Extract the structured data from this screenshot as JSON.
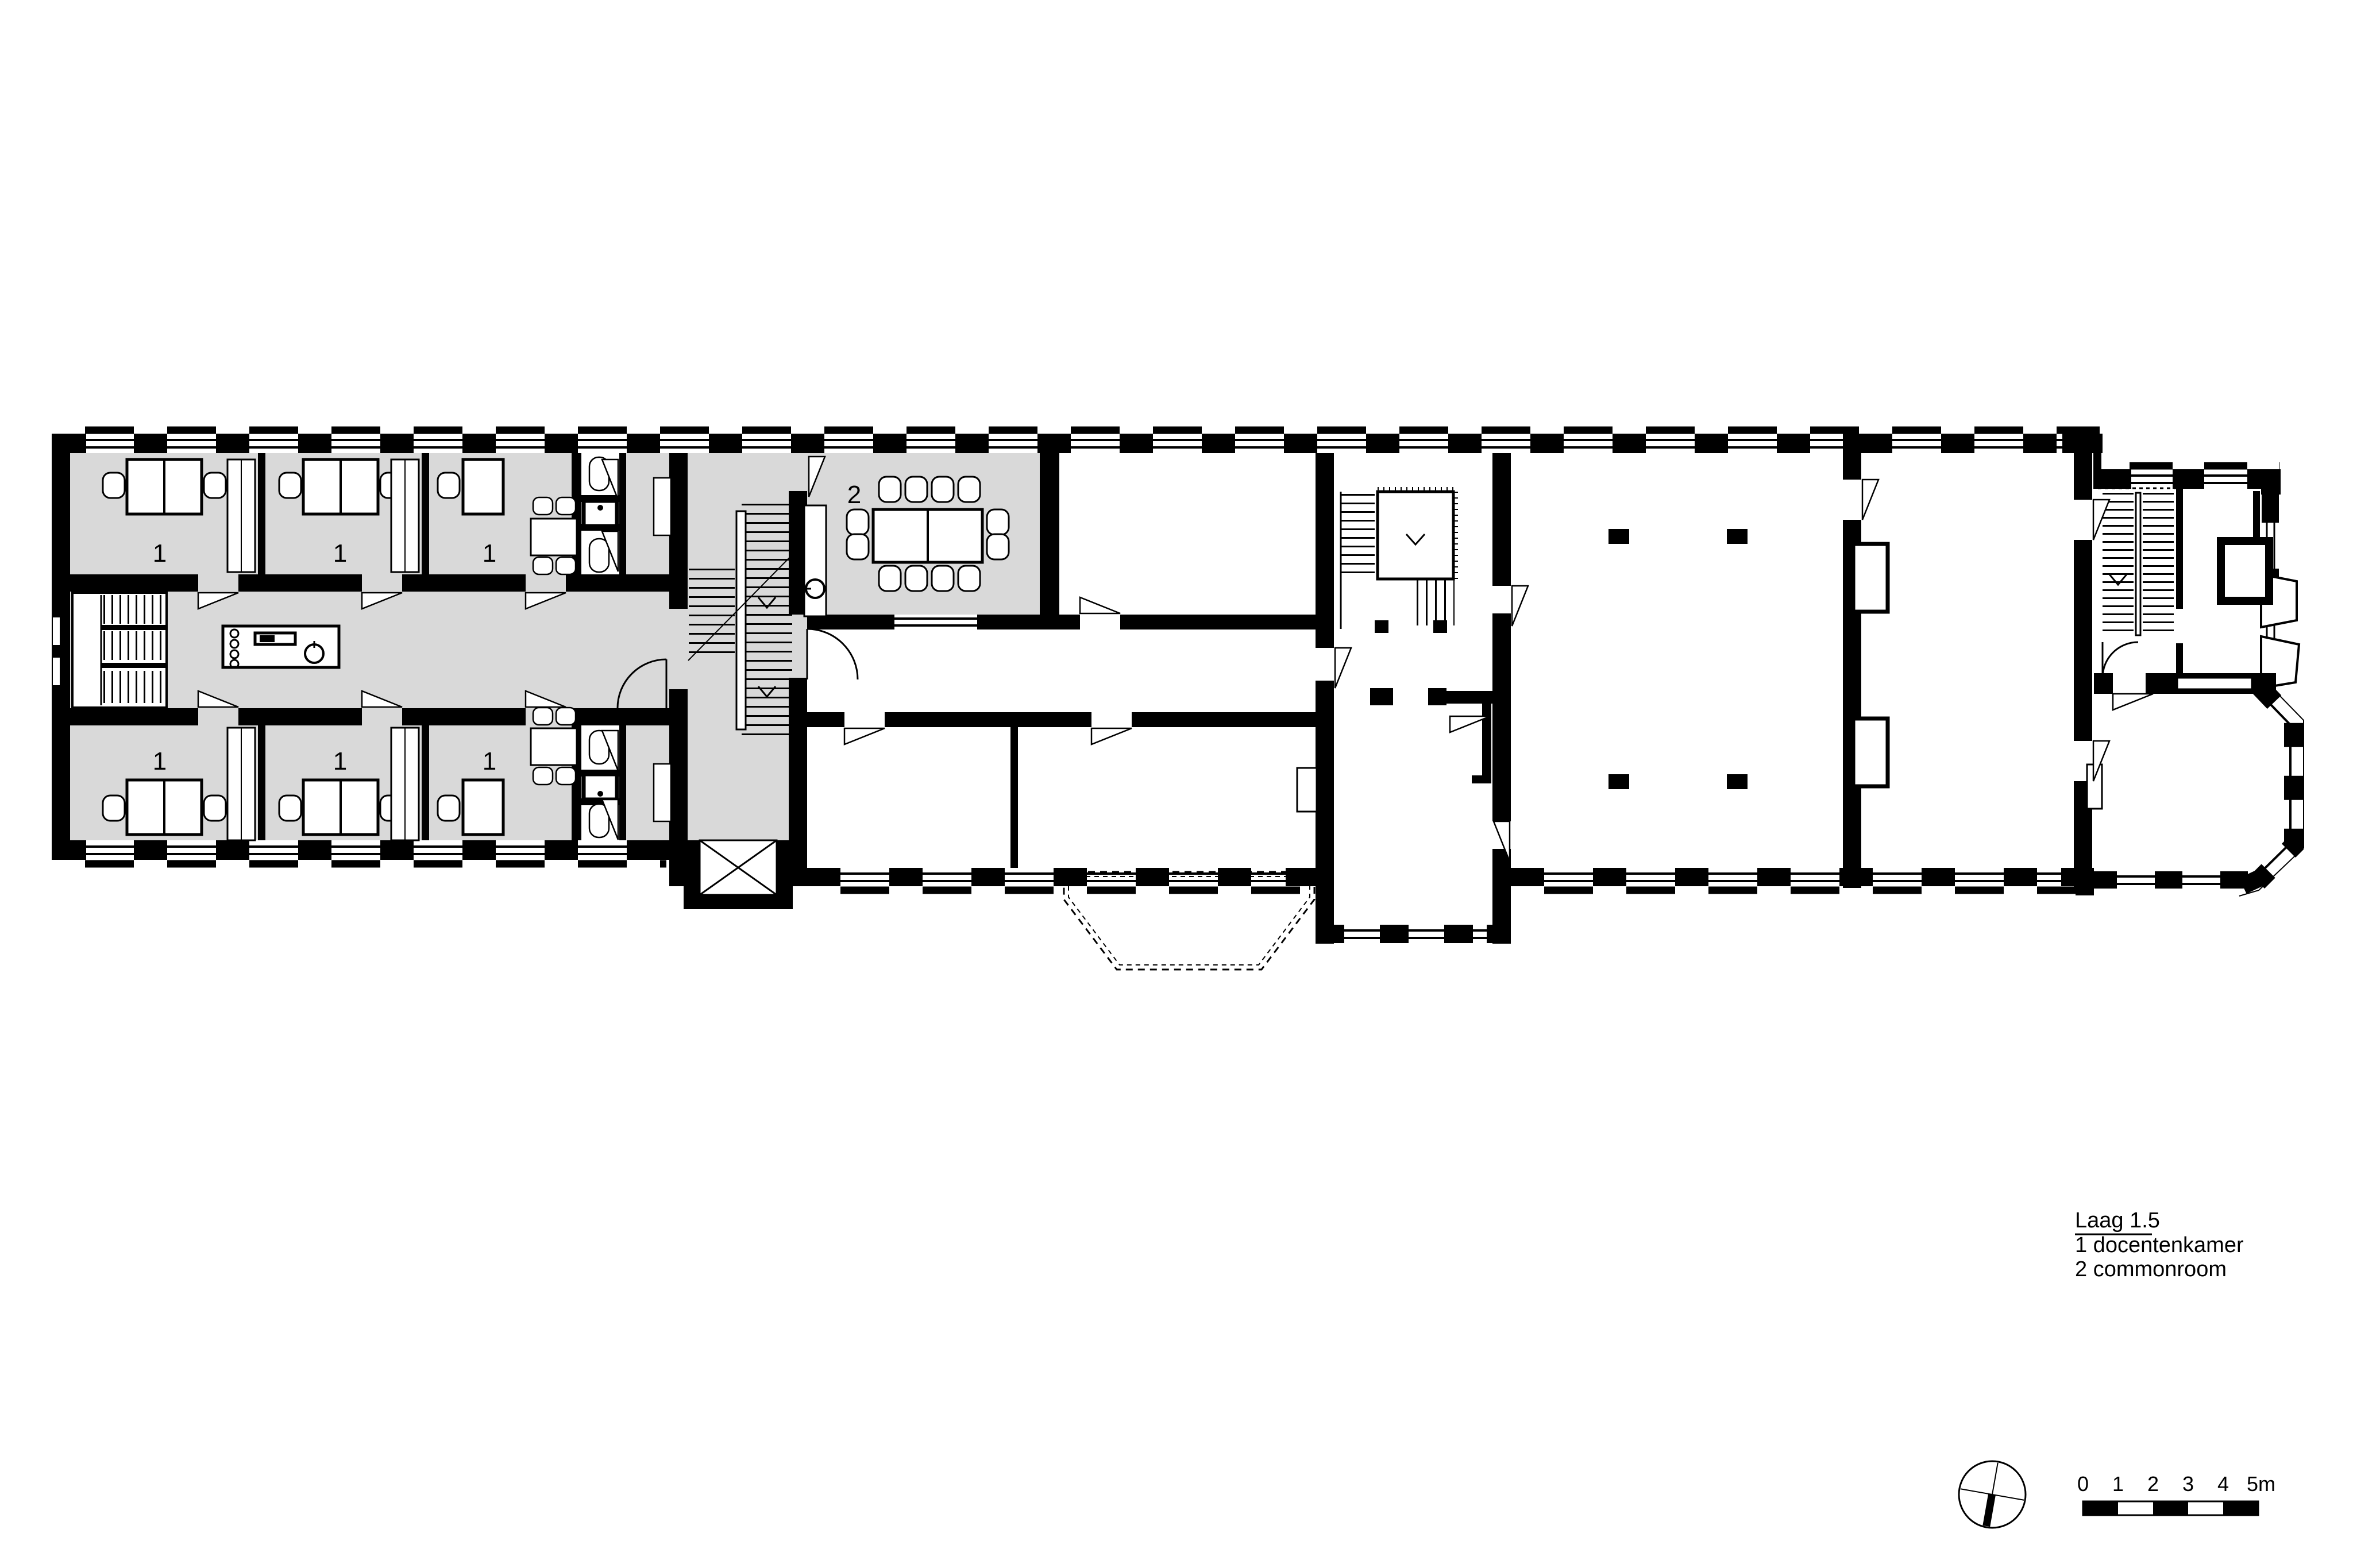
{
  "drawing": {
    "title": "Laag 1.5",
    "legend": [
      {
        "key": "1",
        "label": "1 docentenkamer"
      },
      {
        "key": "2",
        "label": "2 commonroom"
      }
    ],
    "room_labels": {
      "docentenkamer": "1",
      "commonroom": "2"
    },
    "scale_bar": {
      "labels": [
        "0",
        "1",
        "2",
        "3",
        "4",
        "5m"
      ]
    },
    "colors": {
      "floor_highlight": "#d9d9d9",
      "wall": "#000000",
      "paper": "#ffffff"
    }
  }
}
